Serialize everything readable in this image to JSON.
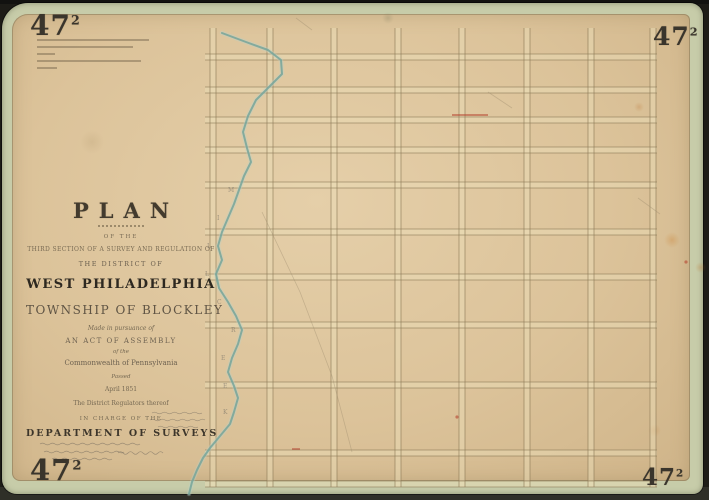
{
  "corner": {
    "number": "47",
    "sup": "2"
  },
  "title_block": {
    "lines": [
      "PLAN",
      "OF THE",
      "THIRD SECTION OF A SURVEY AND REGULATION OF",
      "THE DISTRICT OF",
      "WEST PHILADELPHIA",
      "TOWNSHIP OF BLOCKLEY",
      "Made in pursuance of",
      "AN ACT OF ASSEMBLY",
      "of the",
      "Commonwealth of Pennsylvania",
      "Passed",
      "April 1851",
      "The District Regulators thereof",
      "IN CHARGE OF THE",
      "DEPARTMENT OF SURVEYS"
    ]
  },
  "stamp_lines": [
    {
      "w": 112
    },
    {
      "w": 96
    },
    {
      "w": 18
    },
    {
      "w": 104
    },
    {
      "w": 20
    }
  ],
  "map": {
    "grid": {
      "x1": 205,
      "x2": 657,
      "y1": 28,
      "y2": 487,
      "vertical_streets": [
        213,
        270,
        334,
        398,
        462,
        527,
        591,
        653
      ],
      "horizontal_streets": [
        57,
        90,
        120,
        150,
        185,
        232,
        277,
        325,
        385,
        453,
        484
      ],
      "street_width": 6
    },
    "creek": {
      "label": "MILL CREEK",
      "points": [
        [
          222,
          33
        ],
        [
          246,
          42
        ],
        [
          268,
          50
        ],
        [
          281,
          60
        ],
        [
          282,
          74
        ],
        [
          270,
          86
        ],
        [
          256,
          100
        ],
        [
          248,
          116
        ],
        [
          243,
          132
        ],
        [
          247,
          148
        ],
        [
          251,
          162
        ],
        [
          244,
          176
        ],
        [
          239,
          190
        ],
        [
          234,
          204
        ],
        [
          228,
          218
        ],
        [
          222,
          232
        ],
        [
          218,
          246
        ],
        [
          222,
          260
        ],
        [
          216,
          274
        ],
        [
          219,
          288
        ],
        [
          228,
          302
        ],
        [
          236,
          316
        ],
        [
          242,
          330
        ],
        [
          238,
          344
        ],
        [
          232,
          358
        ],
        [
          228,
          372
        ],
        [
          234,
          386
        ],
        [
          238,
          398
        ],
        [
          234,
          412
        ],
        [
          230,
          424
        ],
        [
          220,
          436
        ],
        [
          210,
          448
        ],
        [
          203,
          458
        ],
        [
          197,
          470
        ],
        [
          192,
          482
        ],
        [
          189,
          494
        ]
      ]
    },
    "diagonals": [
      [
        [
          262,
          212
        ],
        [
          300,
          292
        ],
        [
          332,
          376
        ],
        [
          352,
          452
        ]
      ],
      [
        [
          296,
          18
        ],
        [
          312,
          30
        ]
      ],
      [
        [
          488,
          92
        ],
        [
          512,
          108
        ]
      ],
      [
        [
          638,
          198
        ],
        [
          660,
          214
        ]
      ]
    ],
    "red_marks": {
      "lines": [
        [
          452,
          115,
          488,
          115
        ],
        [
          292,
          449,
          300,
          449
        ]
      ],
      "dots": [
        [
          686,
          262
        ],
        [
          457,
          417
        ]
      ]
    },
    "colors": {
      "street_edge": "#8d7b58",
      "street_fill": "#eadcb6",
      "creek": "#75a49a",
      "creek_halo": "#b7d0c8",
      "red": "#b5432f",
      "faint": "#a29070",
      "ink": "#6a625a"
    }
  }
}
